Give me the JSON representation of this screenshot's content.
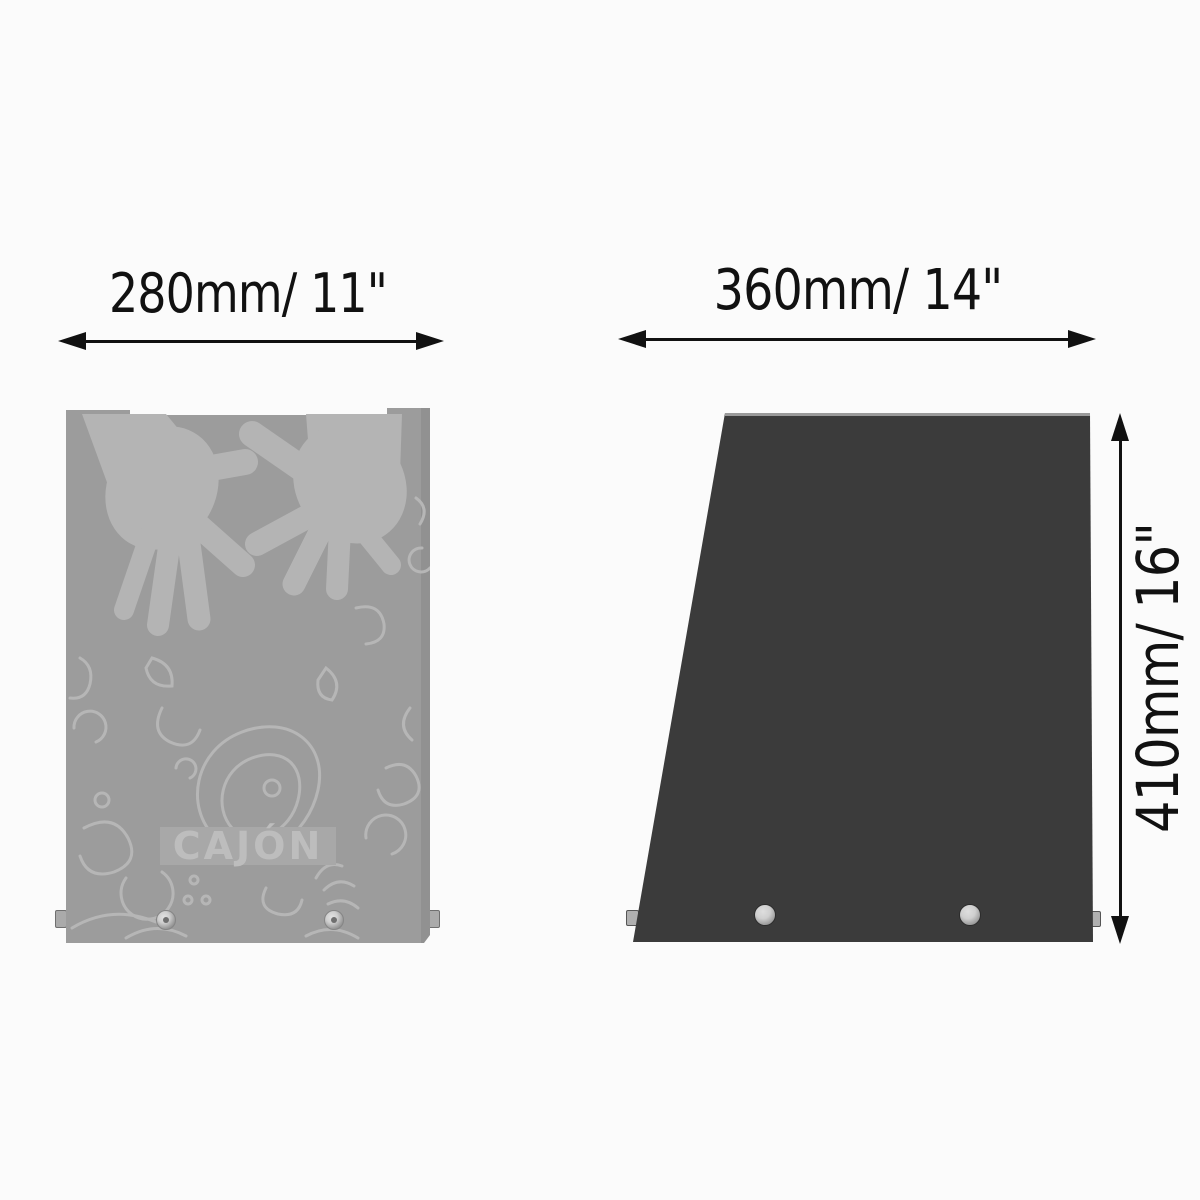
{
  "front_view": {
    "width_dimension": "280mm/ 11\"",
    "brand_label": "CAJÓN"
  },
  "side_view": {
    "width_dimension": "360mm/ 14\"",
    "height_dimension": "410mm/ 16\""
  },
  "colors": {
    "background": "#fbfbfb",
    "ink": "#111111",
    "front_body": "#9c9c9c",
    "front_pattern": "#b6b6b6",
    "front_hands": "#b4b4b4",
    "label_band": "#a8a8a8",
    "label_text": "#bdbdbd",
    "side_body": "#3b3b3b",
    "side_top_edge": "#9a9a9a",
    "hardware_light": "#cfcfcf",
    "hardware_dark": "#777777"
  }
}
